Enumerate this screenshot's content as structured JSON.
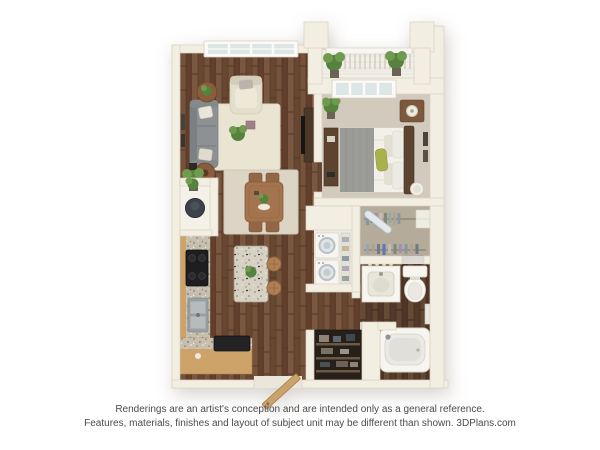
{
  "meta": {
    "description": "3D top-down rendering of a one-bedroom apartment floor plan"
  },
  "disclaimer": {
    "line1": "Renderings are an artist's conception and are intended only as a general reference.",
    "line2": "Features, materials, finishes and layout of subject unit may be different than shown. 3DPlans.com"
  },
  "branding": {
    "watermark": "3DPlans.com"
  },
  "plan": {
    "style": "3d-top-down-rendering",
    "rooms": [
      {
        "name": "living-room",
        "contents": [
          "gray sofa with pillows",
          "cream armchair",
          "two round side tables",
          "cream area rug",
          "plant centerpiece",
          "corner potted plant",
          "tv console",
          "wall art",
          "window"
        ]
      },
      {
        "name": "dining-area",
        "contents": [
          "square wood table",
          "four wood chairs",
          "light rug",
          "green centerpiece"
        ]
      },
      {
        "name": "kitchen",
        "contents": [
          "l-shaped tan counter with granite top",
          "black stove",
          "double stainless sink",
          "granite island with plant",
          "two bar stools",
          "countertop appliance",
          "water heater closet"
        ]
      },
      {
        "name": "bedroom",
        "contents": [
          "bed with gray and white bedding",
          "green accent pillow",
          "dark headboard",
          "nightstand with lamp",
          "dresser",
          "round hamper",
          "potted plant",
          "wall art",
          "sliding glass balcony door"
        ]
      },
      {
        "name": "balcony",
        "contents": [
          "white railing with balusters",
          "two potted plants"
        ]
      },
      {
        "name": "walk-in-closet",
        "contents": [
          "two clothes rods with hanging clothes",
          "ironing board",
          "shelf boxes"
        ]
      },
      {
        "name": "laundry-closet",
        "contents": [
          "stacked washer and dryer",
          "shelf column"
        ]
      },
      {
        "name": "bathroom",
        "contents": [
          "vanity with sink",
          "four vanity lights",
          "toilet",
          "towel rack",
          "bathtub with faucet"
        ]
      },
      {
        "name": "linen-closet",
        "contents": [
          "dark shelves with linens"
        ]
      },
      {
        "name": "entry",
        "contents": [
          "open wood front door"
        ]
      }
    ]
  },
  "colors": {
    "background": "#ffffff",
    "wall": "#f2eee2",
    "wallEdge": "#d9d1bf",
    "carpet": "#d2cbbd",
    "rug": "#eae4d3",
    "diningRug": "#dcd5c5",
    "sofa": "#8e9193",
    "cream": "#e4decd",
    "cabinet": "#cda369",
    "darkWood": "#5d4430",
    "woodFloor": "#6f4e3a",
    "bathFloor": "#5c4330",
    "plant": "#55823c",
    "plantLight": "#6f9b50",
    "fixture": "#f6f5f0",
    "fixtureEdge": "#d9d3c6",
    "stove": "#1e1e20",
    "closetFloor": "#b4ab9b",
    "laundryFloor": "#edebe4",
    "linenDark": "#262019",
    "text": "#4b4b4b"
  }
}
